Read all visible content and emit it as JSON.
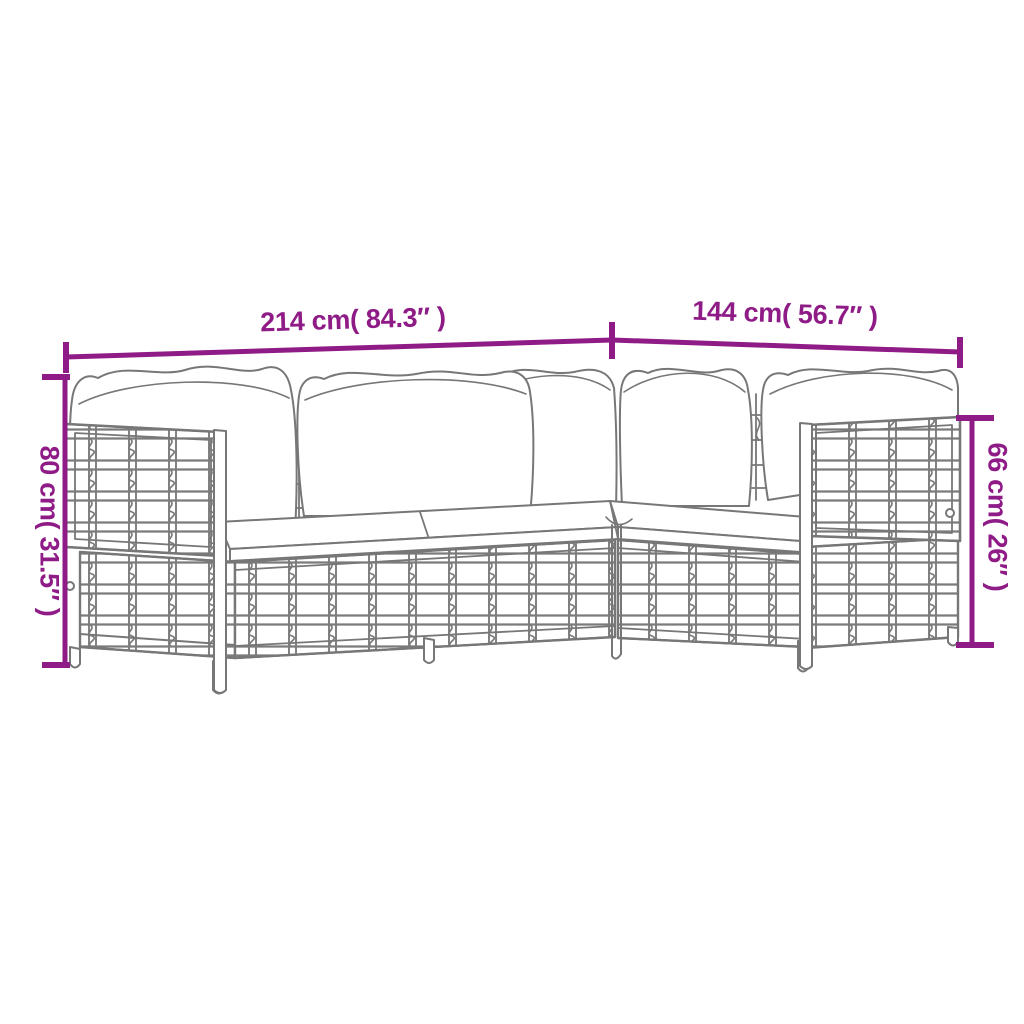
{
  "diagram": {
    "background_color": "#ffffff",
    "accent_color": "#8e1b86",
    "sketch_color": "#777777",
    "illustration": "wicker-modular-sofa-line-drawing",
    "dimensions": {
      "width": {
        "label": "214 cm( 84.3″ )"
      },
      "depth": {
        "label": "144 cm( 56.7″ )"
      },
      "back_height": {
        "label": "80 cm( 31.5″ )"
      },
      "arm_height": {
        "label": "66 cm( 26″ )"
      }
    }
  }
}
